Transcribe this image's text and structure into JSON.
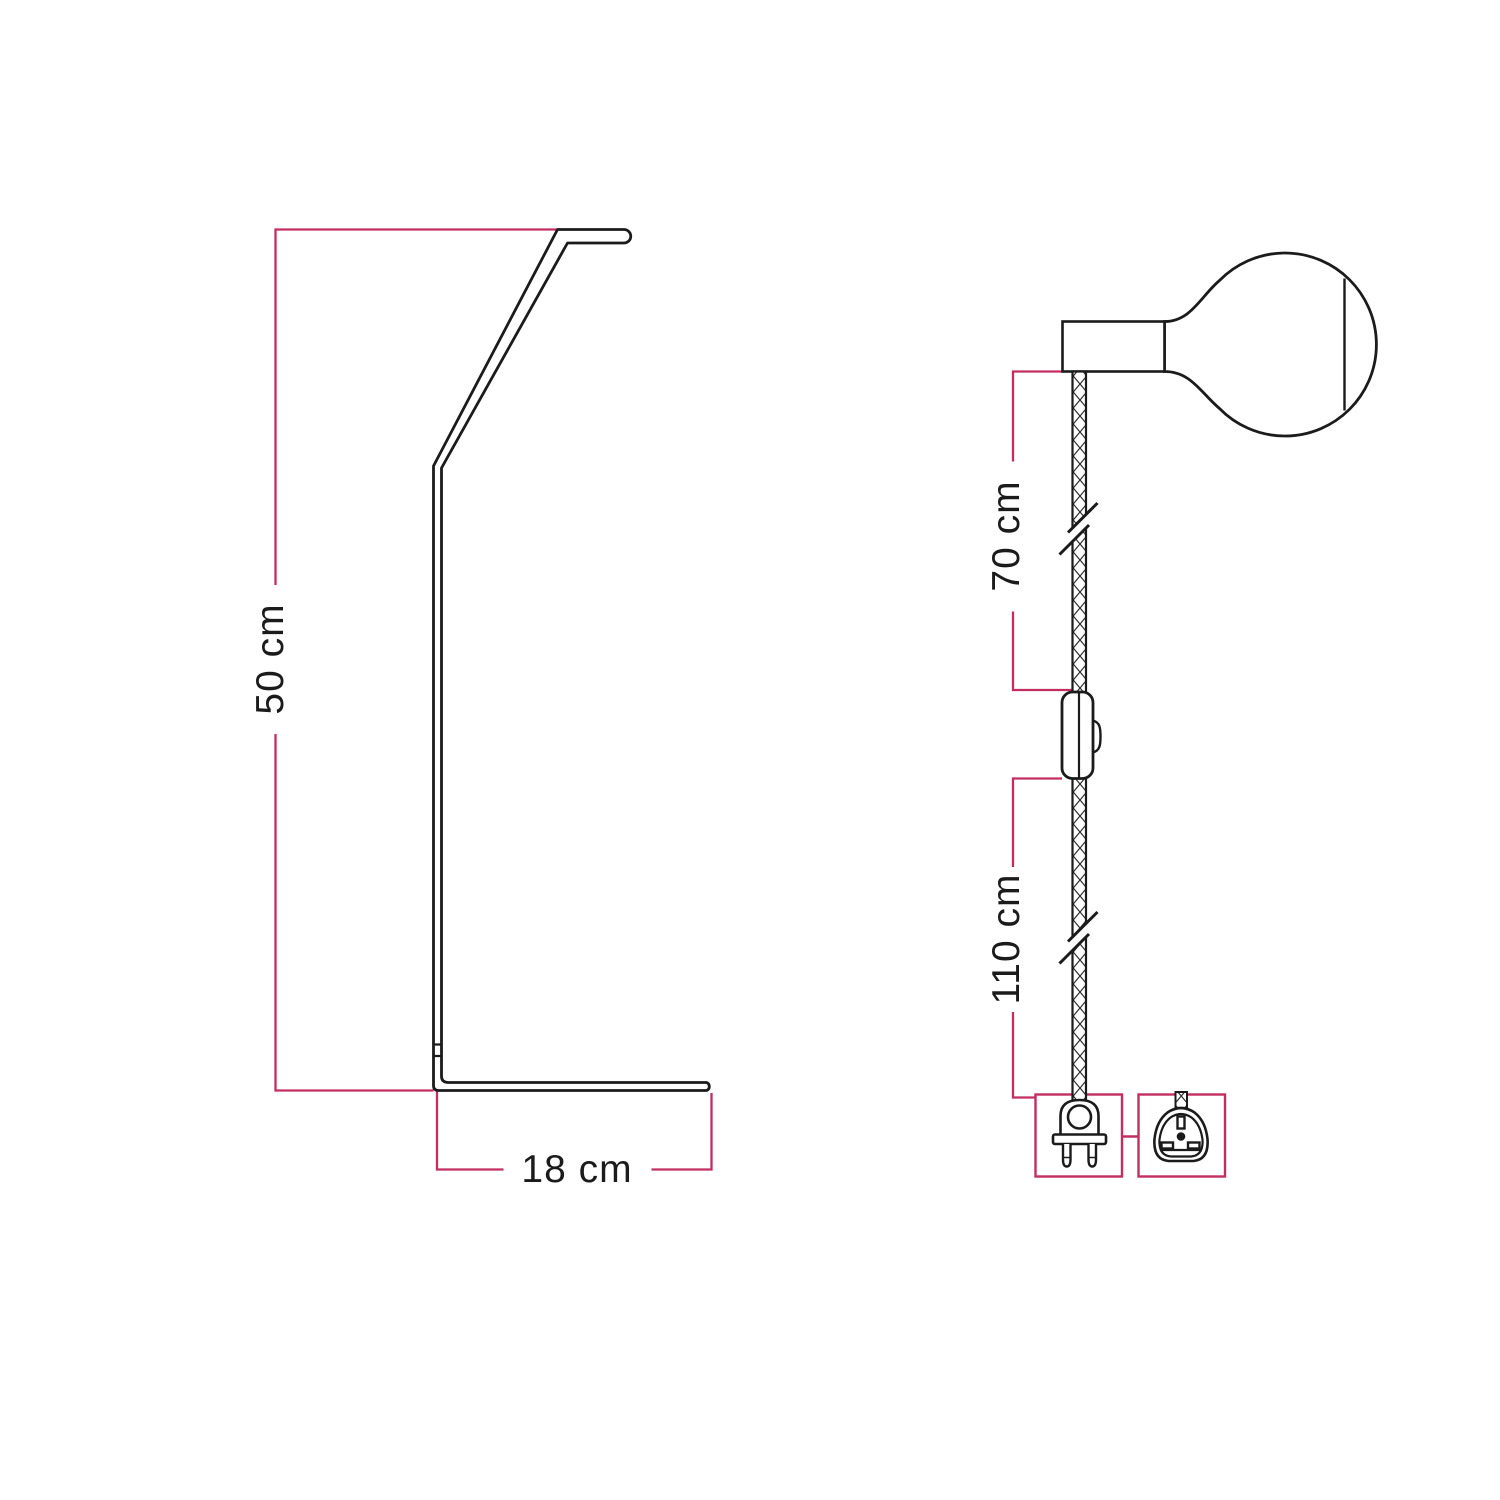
{
  "figure": {
    "type": "product-dimension-diagram",
    "background": "#ffffff",
    "line_color": "#1b1b1b",
    "dimension_color": "#c32e60"
  },
  "left_figure": {
    "name": "table-lamp-stand-side-profile",
    "height_label": "50 cm",
    "base_label": "18 cm"
  },
  "right_figure": {
    "name": "plug-in-pendant-cable-with-bulb",
    "upper_cable_label": "70 cm",
    "lower_cable_label": "110 cm",
    "icons": [
      "light-bulb-icon",
      "lamp-holder-icon",
      "textile-cable-icon",
      "cable-break-icon",
      "inline-switch-icon",
      "eu-plug-icon",
      "uk-plug-icon"
    ],
    "plug_types": [
      "eu-2-pin",
      "uk-3-pin"
    ]
  }
}
